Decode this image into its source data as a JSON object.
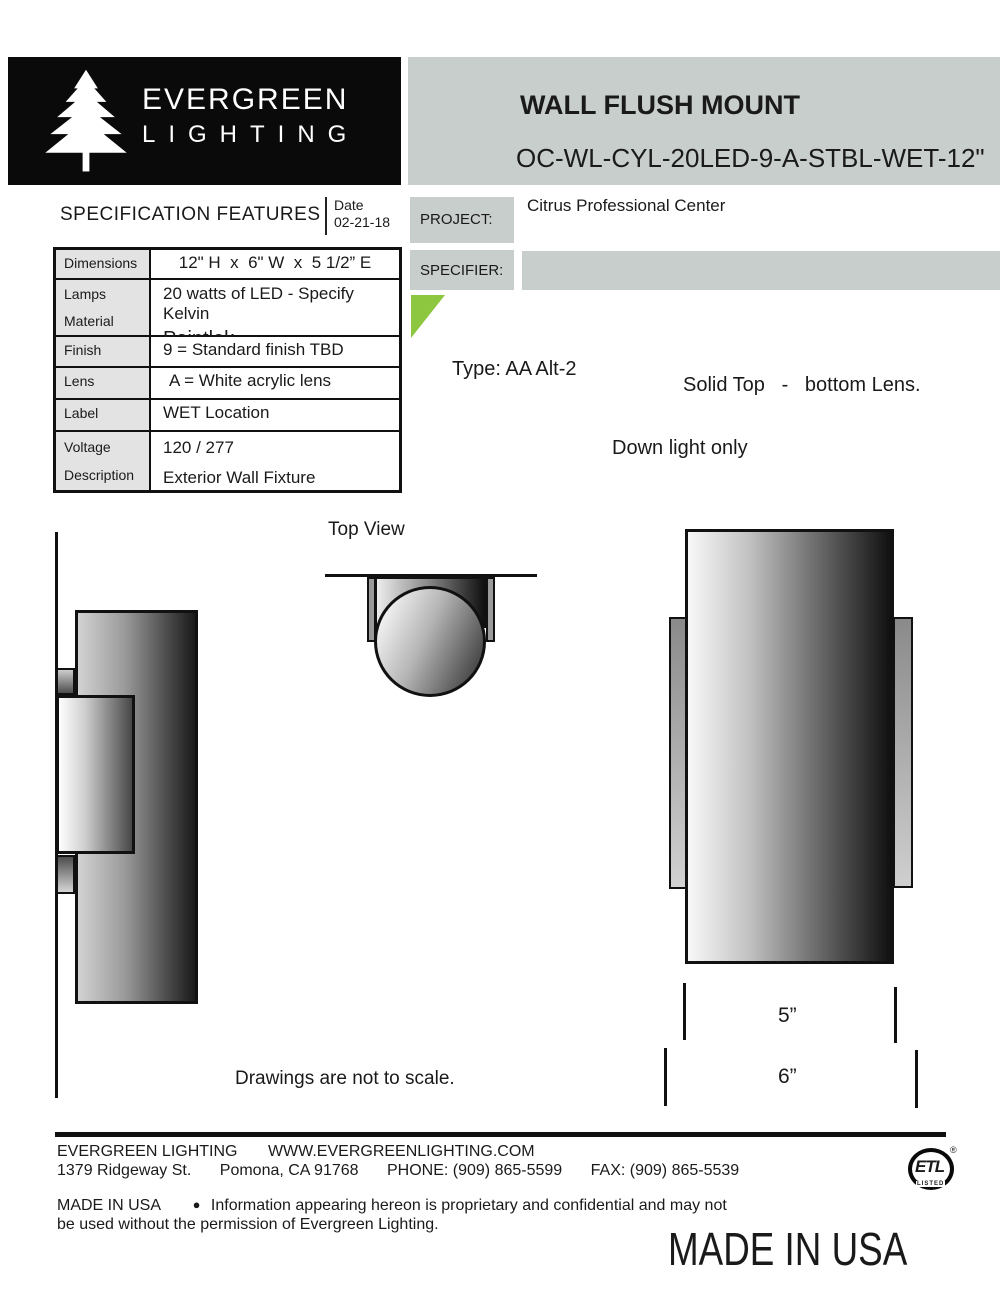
{
  "colors": {
    "accent_green": "#8dc63f",
    "panel_gray": "#c8cecb",
    "table_label_gray": "#e3e3e3",
    "ink": "#1a1a1a"
  },
  "logo": {
    "name_line1": "EVERGREEN",
    "name_line2": "LIGHTING"
  },
  "header": {
    "product_title": "WALL FLUSH MOUNT",
    "model_code": "OC-WL-CYL-20LED-9-A-STBL-WET-12\""
  },
  "spec": {
    "heading": "SPECIFICATION FEATURES",
    "date_label": "Date",
    "date_value": "02-21-18",
    "rows": {
      "dimensions": {
        "label": "Dimensions",
        "value": "12\" H  x  6\" W  x  5 1/2” E"
      },
      "lamps": {
        "label": "Lamps",
        "value": "20 watts of LED - Specify Kelvin"
      },
      "material": {
        "label": "Material",
        "value": "Paintlok"
      },
      "finish": {
        "label": "Finish",
        "value": "9 = Standard finish TBD"
      },
      "lens": {
        "label": "Lens",
        "value": "A = White acrylic lens"
      },
      "label": {
        "label": "Label",
        "value": "WET Location"
      },
      "voltage": {
        "label": "Voltage",
        "value": "120 / 277"
      },
      "description": {
        "label": "Description",
        "value": "Exterior Wall Fixture"
      }
    }
  },
  "project": {
    "label": "PROJECT:",
    "value": "Citrus Professional Center"
  },
  "specifier": {
    "label": "SPECIFIER:",
    "value": ""
  },
  "notes": {
    "type_note": "Type: AA Alt-2",
    "lens_note": "Solid Top   -   bottom Lens.",
    "light_note": "Down light only"
  },
  "drawings": {
    "top_view_label": "Top View",
    "disclaimer": "Drawings are not to scale.",
    "width_dim": "5”",
    "overall_dim": "6”"
  },
  "footer": {
    "company": "EVERGREEN LIGHTING",
    "website": "WWW.EVERGREENLIGHTING.COM",
    "address": "1379 Ridgeway St.",
    "city": "Pomona, CA 91768",
    "phone": "PHONE: (909) 865-5599",
    "fax": "FAX: (909) 865-5539",
    "made_in": "MADE IN USA",
    "bullet": "●",
    "notice_line1": "Information appearing hereon is proprietary and confidential and may not",
    "notice_line2": "be used without the permission of Evergreen Lighting.",
    "big_made_in": "MADE IN USA",
    "etl": {
      "mark": "ETL",
      "listed": "LISTED",
      "registered": "®"
    }
  }
}
